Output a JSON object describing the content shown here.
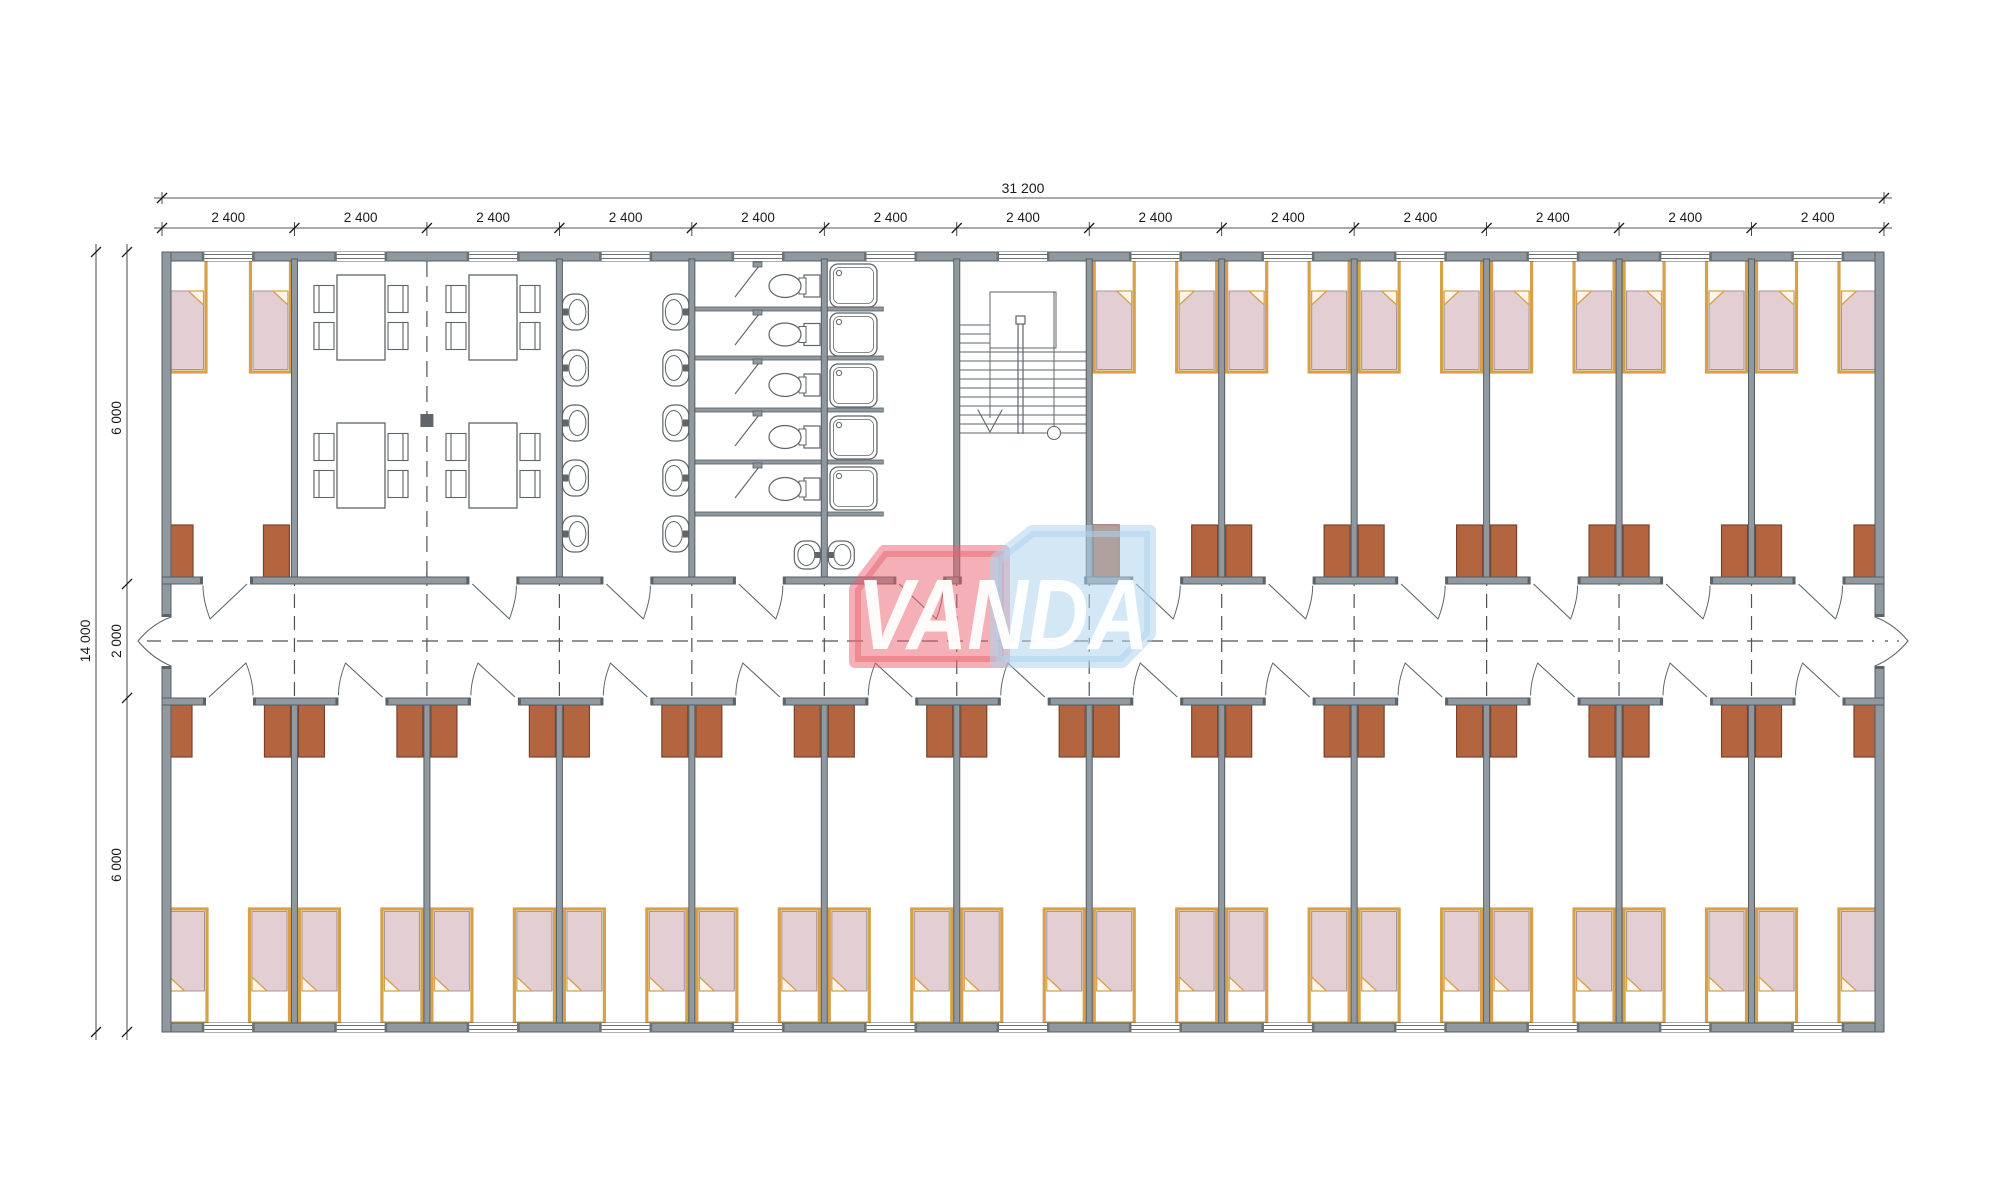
{
  "title": "modular dormitory floor plan",
  "dimensions": {
    "top_total": "31 200",
    "top_modules": [
      "2 400",
      "2 400",
      "2 400",
      "2 400",
      "2 400",
      "2 400",
      "2 400",
      "2 400",
      "2 400",
      "2 400",
      "2 400",
      "2 400",
      "2 400"
    ],
    "left_total": "14 000",
    "left_segments": [
      "6 000",
      "2 000",
      "6 000"
    ]
  },
  "logo": {
    "text": "VANDA",
    "red": "#e9626d",
    "blue": "#aed4ec",
    "text_color": "rgba(255,255,255,0.95)"
  },
  "palette": {
    "wall": "#8f999f",
    "wall_edge": "#555e63",
    "line": "#5f6569",
    "dash": "#4d5356",
    "dim_text": "#1b1b1b",
    "bed_frame": "#d7a14b",
    "bed_blanket": "#e3ced3",
    "bed_fold": "#fdf6ec",
    "locker": "#b2653f",
    "locker_edge": "#7a422b",
    "fixture_fill": "#ffffff"
  },
  "plan": {
    "module_count": 13,
    "top_rooms": [
      {
        "id": "bedroom-top-corner",
        "type": "bedroom",
        "beds": 2,
        "lockers": 2
      },
      {
        "id": "dining-room",
        "type": "dining",
        "tables": 4,
        "chairs": 16
      },
      {
        "id": "washroom",
        "type": "washroom",
        "basins": 10
      },
      {
        "id": "wc-room",
        "type": "wc",
        "toilets": 5,
        "stalls": 5
      },
      {
        "id": "shower-room",
        "type": "shower",
        "trays": 5,
        "basins": 2
      },
      {
        "id": "stairwell",
        "type": "stair",
        "flights": 1
      },
      {
        "id": "bedrooms-top-right",
        "type": "bedrooms",
        "count": 6,
        "beds_each": 2,
        "lockers_each": 2
      }
    ],
    "bottom_rooms": {
      "id": "bedrooms-bottom",
      "type": "bedrooms",
      "count": 13,
      "beds_each": 2,
      "lockers_each": 2
    }
  }
}
